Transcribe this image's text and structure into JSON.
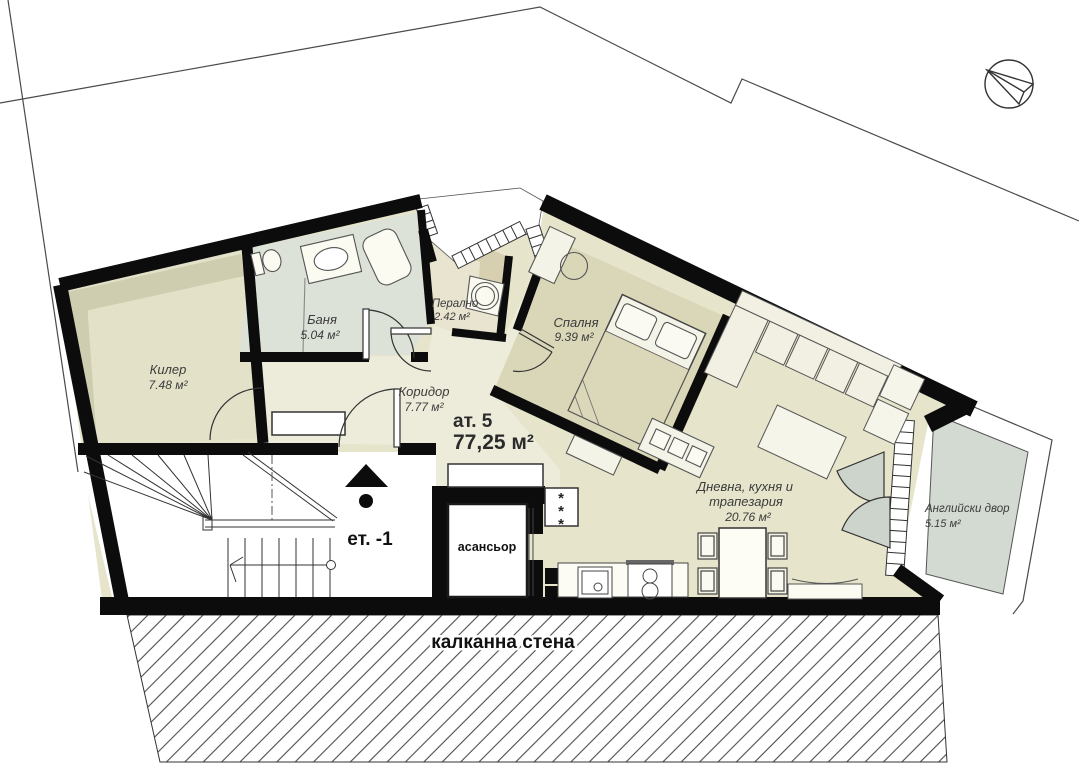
{
  "plan": {
    "apartment": {
      "label": "ат. 5",
      "area": "77,25 м²"
    },
    "rooms": {
      "kiler": {
        "name": "Килер",
        "area": "7.48 м²"
      },
      "banya": {
        "name": "Баня",
        "area": "5.04 м²"
      },
      "peralno": {
        "name": "Перално",
        "area": "2.42 м²"
      },
      "koridor": {
        "name": "Коридор",
        "area": "7.77 м²"
      },
      "spalnya": {
        "name": "Спалня",
        "area": "9.39 м²"
      },
      "dnevna": {
        "name_line1": "Дневна, кухня и",
        "name_line2": "трапезария",
        "area": "20.76 м²"
      },
      "dvor": {
        "name": "Английски двор",
        "area": "5.15 м²"
      }
    },
    "labels": {
      "elevator": "асансьор",
      "floor_level": "ет. -1",
      "party_wall": "калканна стена",
      "vent_symbol": "*"
    },
    "icons": {
      "north_arrow": "north-arrow",
      "entrance_arrow": "entrance-arrow"
    },
    "colors": {
      "wall": "#0c0c0c",
      "floor_main": "#e6e5cc",
      "floor_corridor": "#edecdb",
      "floor_bedroom": "#d9d7b8",
      "floor_bath": "#dde2d8",
      "floor_laundry": "#e8e4cf",
      "floor_yard": "#d3dad1",
      "shelf": "#cecdb0",
      "boundary_line": "#4a4a4a"
    }
  }
}
